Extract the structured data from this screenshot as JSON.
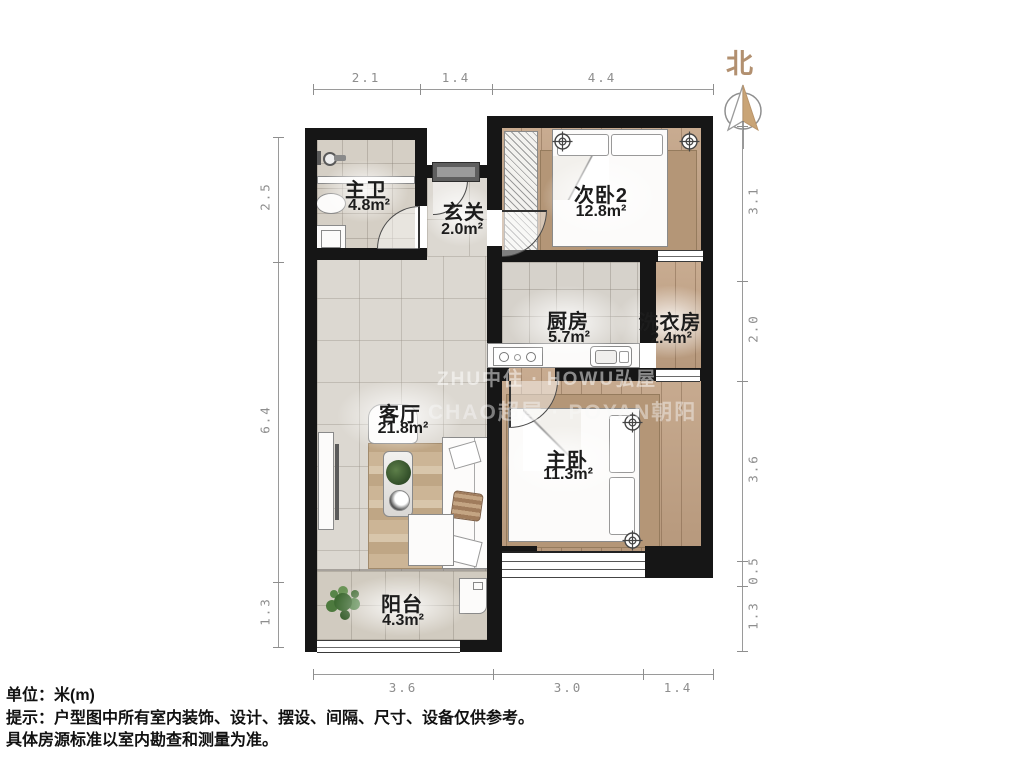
{
  "north": {
    "label": "北"
  },
  "rooms": {
    "master_bath": {
      "name": "主卫",
      "area": "4.8m²"
    },
    "hallway": {
      "name": "玄关",
      "area": "2.0m²"
    },
    "bedroom2": {
      "name": "次卧2",
      "area": "12.8m²"
    },
    "kitchen": {
      "name": "厨房",
      "area": "5.7m²"
    },
    "laundry": {
      "name": "洗衣房",
      "area": "2.4m²"
    },
    "living": {
      "name": "客厅",
      "area": "21.8m²"
    },
    "master_bedroom": {
      "name": "主卧",
      "area": "11.3m²"
    },
    "balcony": {
      "name": "阳台",
      "area": "4.3m²"
    }
  },
  "dimensions": {
    "top": [
      "2.1",
      "1.4",
      "4.4"
    ],
    "bottom": [
      "3.6",
      "3.0",
      "1.4"
    ],
    "left": [
      "2.5",
      "6.4",
      "1.3"
    ],
    "right": [
      "3.1",
      "2.0",
      "3.6",
      "0.5",
      "1.3"
    ]
  },
  "watermarks": {
    "line1": "ZHU中住 · HOWU弘屋",
    "line2": "CHAO超屋 · POYAN朝阳"
  },
  "footer": {
    "unit": "单位：米(m)",
    "tip1": "提示：户型图中所有室内装饰、设计、摆设、间隔、尺寸、设备仅供参考。",
    "tip2": "具体房源标准以室内勘查和测量为准。"
  },
  "colors": {
    "wall": "#161616",
    "wood_floor": "#c2a284",
    "tile_floor": "#dcd8d1",
    "north_accent": "#b29070",
    "dimension_gray": "#8e8e8e"
  }
}
